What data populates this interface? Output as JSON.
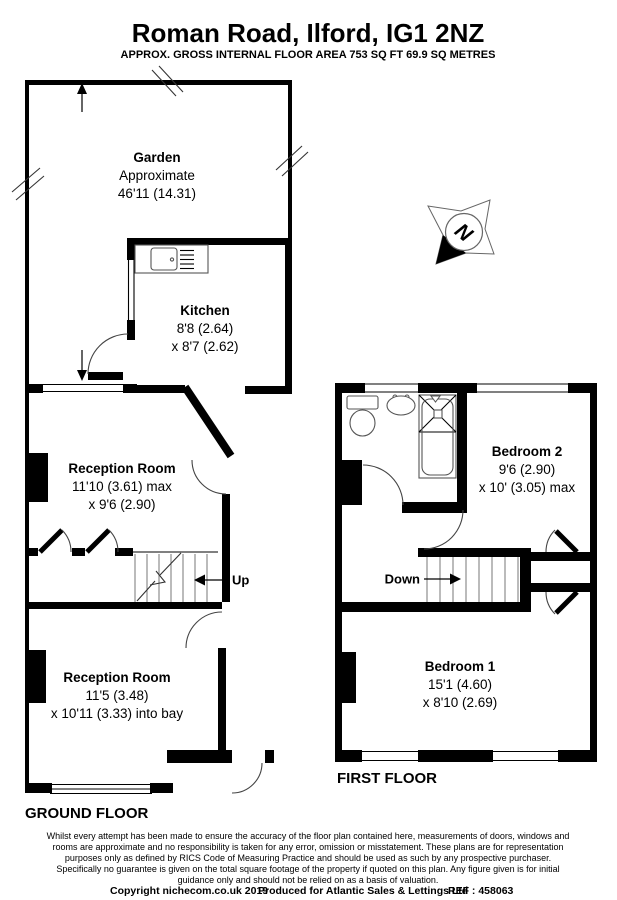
{
  "header": {
    "title": "Roman Road, Ilford, IG1 2NZ",
    "subtitle": "APPROX. GROSS INTERNAL FLOOR AREA 753 SQ FT 69.9 SQ METRES"
  },
  "rooms": {
    "garden": {
      "name": "Garden",
      "dim1": "Approximate",
      "dim2": "46'11 (14.31)"
    },
    "kitchen": {
      "name": "Kitchen",
      "dim1": "8'8 (2.64)",
      "dim2": "x 8'7 (2.62)"
    },
    "reception1": {
      "name": "Reception Room",
      "dim1": "11'10 (3.61) max",
      "dim2": "x 9'6 (2.90)"
    },
    "reception2": {
      "name": "Reception Room",
      "dim1": "11'5 (3.48)",
      "dim2": "x 10'11 (3.33) into bay"
    },
    "bedroom2": {
      "name": "Bedroom 2",
      "dim1": "9'6 (2.90)",
      "dim2": "x 10' (3.05) max"
    },
    "bedroom1": {
      "name": "Bedroom 1",
      "dim1": "15'1 (4.60)",
      "dim2": "x 8'10 (2.69)"
    }
  },
  "stairs": {
    "up": "Up",
    "down": "Down"
  },
  "compass": {
    "north": "N"
  },
  "floors": {
    "ground": "GROUND FLOOR",
    "first": "FIRST FLOOR"
  },
  "footer": {
    "disclaimer": [
      "Whilst every attempt has been made to ensure the accuracy of the floor plan contained here, measurements of doors, windows and",
      "rooms are approximate and no responsibility is taken for any error, omission or misstatement. These plans are for representation",
      "purposes only as defined by RICS Code of Measuring Practice and should be used as such by any prospective purchaser.",
      "Specifically no guarantee is given on the total square footage of the property if quoted on this plan. Any figure given is for initial",
      "guidance only and should not be relied on as a basis of valuation."
    ],
    "copyright_1": "Copyright nichecom.co.uk 2019",
    "copyright_2": "Produced for Atlantic Sales & Lettings Ltd",
    "copyright_3": "REF :  458063"
  },
  "colors": {
    "wall": "#000000",
    "background": "#ffffff"
  }
}
